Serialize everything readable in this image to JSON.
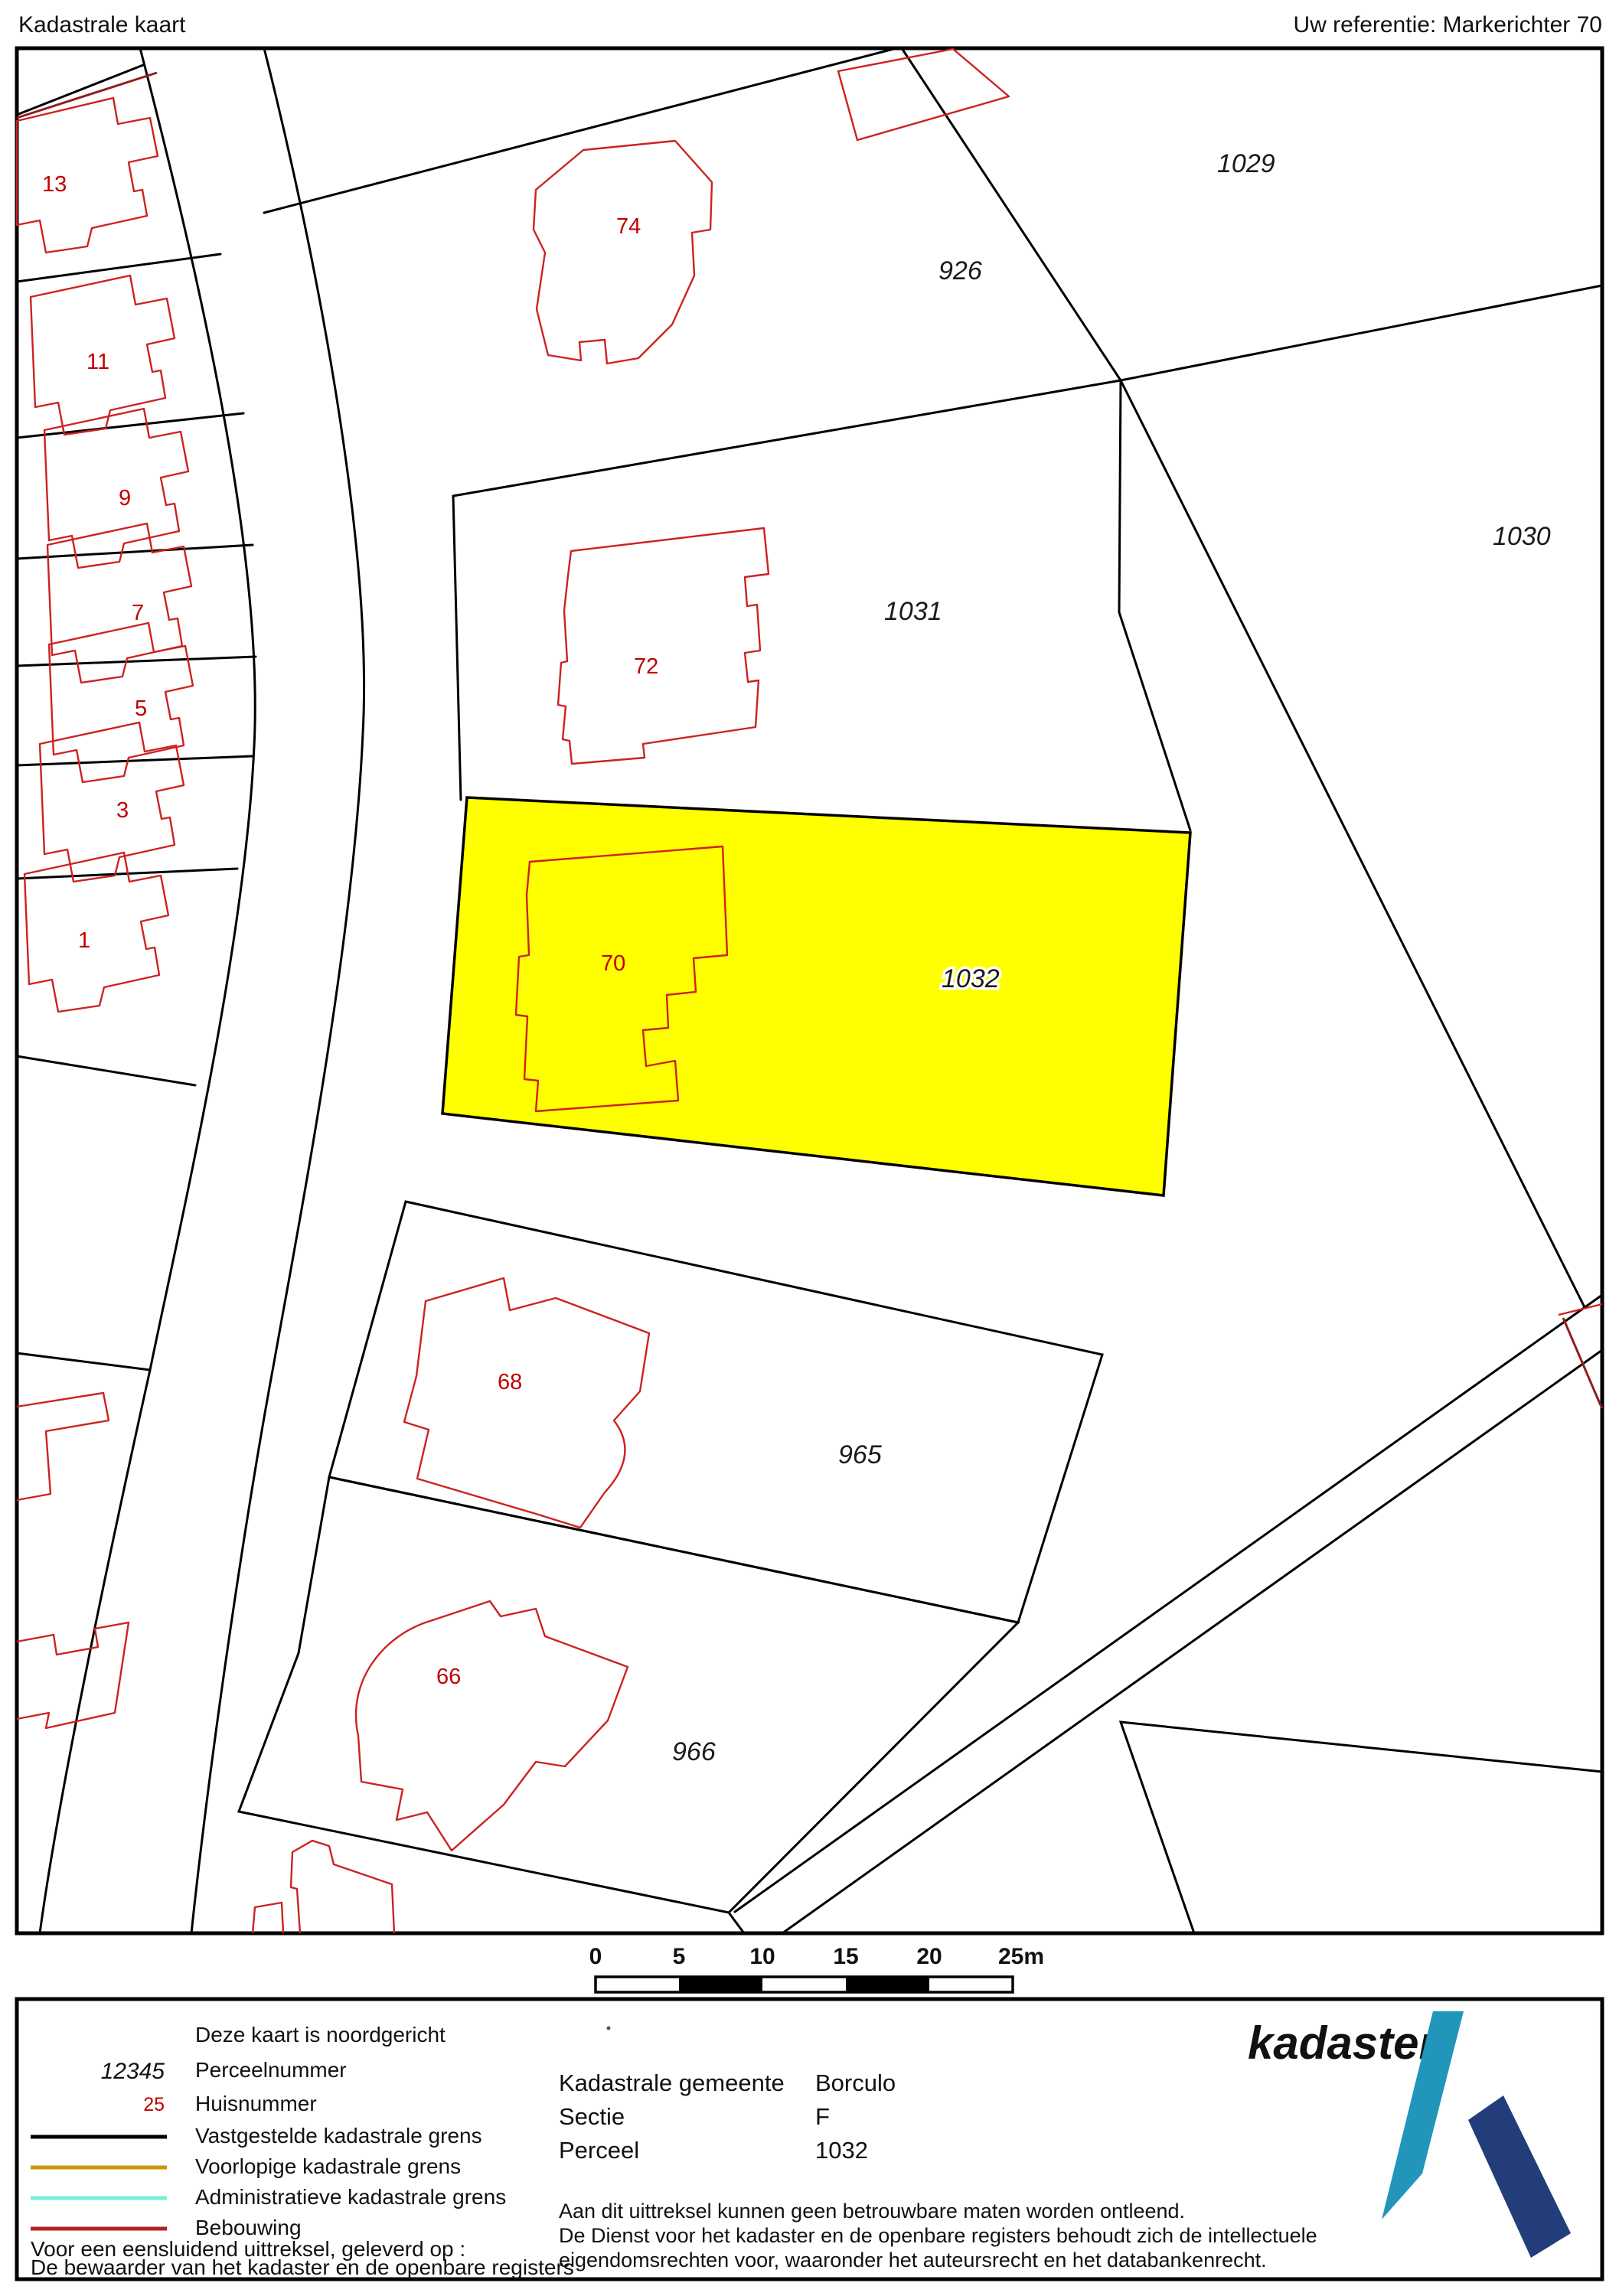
{
  "header": {
    "title": "Kadastrale kaart",
    "reference": "Uw referentie: Markerichter 70"
  },
  "map": {
    "highlight_color": "#ffff00",
    "boundary_color": "#000000",
    "building_color": "#cc2222",
    "parcel_labels": [
      {
        "text": "926"
      },
      {
        "text": "1029"
      },
      {
        "text": "1030"
      },
      {
        "text": "1031"
      },
      {
        "text": "1032",
        "highlighted": true
      },
      {
        "text": "965"
      },
      {
        "text": "966"
      }
    ],
    "house_labels": [
      {
        "text": "13"
      },
      {
        "text": "11"
      },
      {
        "text": "9"
      },
      {
        "text": "7"
      },
      {
        "text": "5"
      },
      {
        "text": "3"
      },
      {
        "text": "1"
      },
      {
        "text": "74"
      },
      {
        "text": "72"
      },
      {
        "text": "70"
      },
      {
        "text": "68"
      },
      {
        "text": "66"
      }
    ]
  },
  "scalebar": {
    "ticks": [
      "0",
      "5",
      "10",
      "15",
      "20",
      "25m"
    ]
  },
  "legend": {
    "north_note": "Deze kaart is noordgericht",
    "items": [
      {
        "sample": "12345",
        "label": "Perceelnummer"
      },
      {
        "sample": "25",
        "label": "Huisnummer"
      },
      {
        "label": "Vastgestelde kadastrale grens",
        "color": "#000000"
      },
      {
        "label": "Voorlopige kadastrale grens",
        "color": "#c8960c"
      },
      {
        "label": "Administratieve kadastrale grens",
        "color": "#76eed9"
      },
      {
        "label": "Bebouwing",
        "color": "#b22222"
      }
    ],
    "footer1": "Voor een eensluidend uittreksel, geleverd op :",
    "footer2": "De bewaarder van het kadaster en de openbare registers"
  },
  "info": {
    "rows": [
      {
        "label": "Kadastrale gemeente",
        "value": "Borculo"
      },
      {
        "label": "Sectie",
        "value": "F"
      },
      {
        "label": "Perceel",
        "value": "1032"
      }
    ],
    "disclaimer": [
      "Aan dit uittreksel kunnen geen betrouwbare maten worden ontleend.",
      "De Dienst voor het kadaster en de openbare registers behoudt zich de intellectuele",
      "eigendomsrechten voor, waaronder het auteursrecht en het databankenrecht."
    ]
  },
  "logo": {
    "text": "kadaster",
    "word_color": "#2e77b5",
    "light_color": "#2196ba",
    "dark_color": "#223d7a"
  }
}
